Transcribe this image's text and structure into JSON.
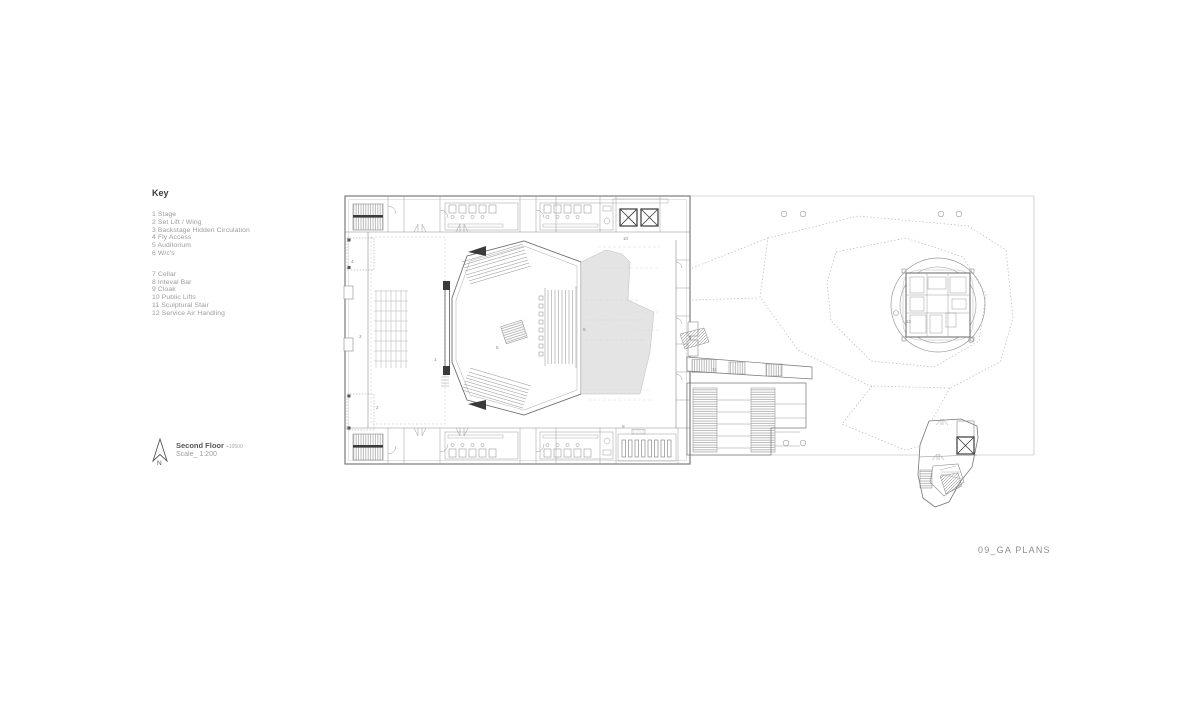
{
  "key": {
    "title": "Key",
    "group1": [
      "1 Stage",
      "2 Set Lift / Wing",
      "3 Backstage Hidden Circulation",
      "4 Fly Access",
      "5 Auditorium",
      "6 W/c's"
    ],
    "group2": [
      "7 Cellar",
      "8 Inteval Bar",
      "9 Cloak",
      "10 Public Lifts",
      "11 Sculptural Stair",
      "12 Service Air Handling"
    ]
  },
  "titleblock": {
    "floor_name": "Second Floor",
    "level": "+10500",
    "scale": "Scale_ 1:200",
    "north_label": "N"
  },
  "sheet": {
    "title": "09_GA PLANS"
  },
  "plan": {
    "labels": {
      "l1": "1",
      "l2": "2",
      "l3": "3",
      "l4": "4",
      "l5": "5",
      "l8": "8",
      "l9": "9",
      "l10": "10",
      "l11": "11",
      "l12": "12"
    }
  },
  "colors": {
    "wall": "#6e6e6e",
    "detail": "#9a9a9a",
    "dark": "#3a3a3a",
    "shade": "#e4e4e4",
    "dotted": "#b0b0b0",
    "text_grey": "#9b9b9b"
  }
}
